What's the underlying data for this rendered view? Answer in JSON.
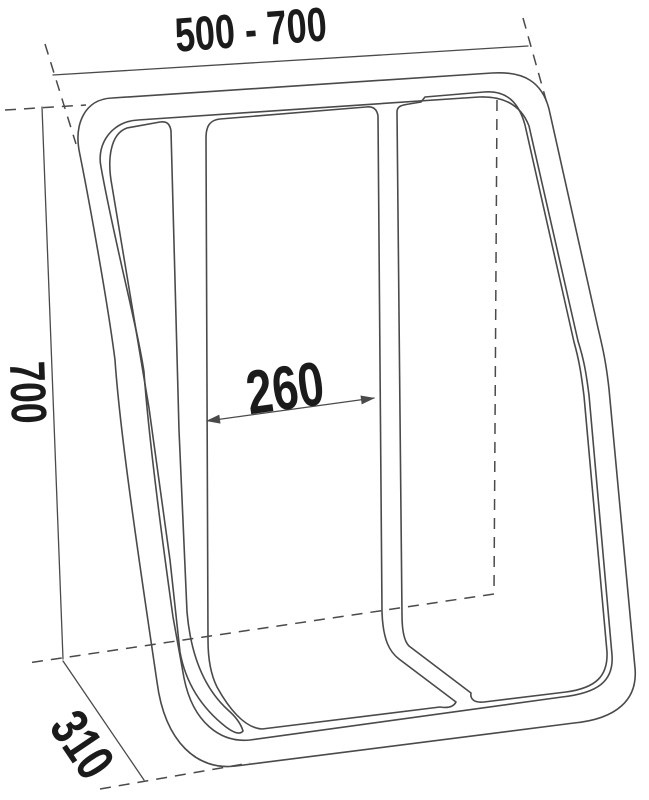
{
  "drawing": {
    "type": "technical-dimension-drawing",
    "background_color": "#ffffff",
    "line_color": "#4a4a4a",
    "text_color": "#1b1b1b",
    "labels": {
      "width_range": "500 - 700",
      "height": "700",
      "inner_width": "260",
      "depth": "310"
    }
  }
}
